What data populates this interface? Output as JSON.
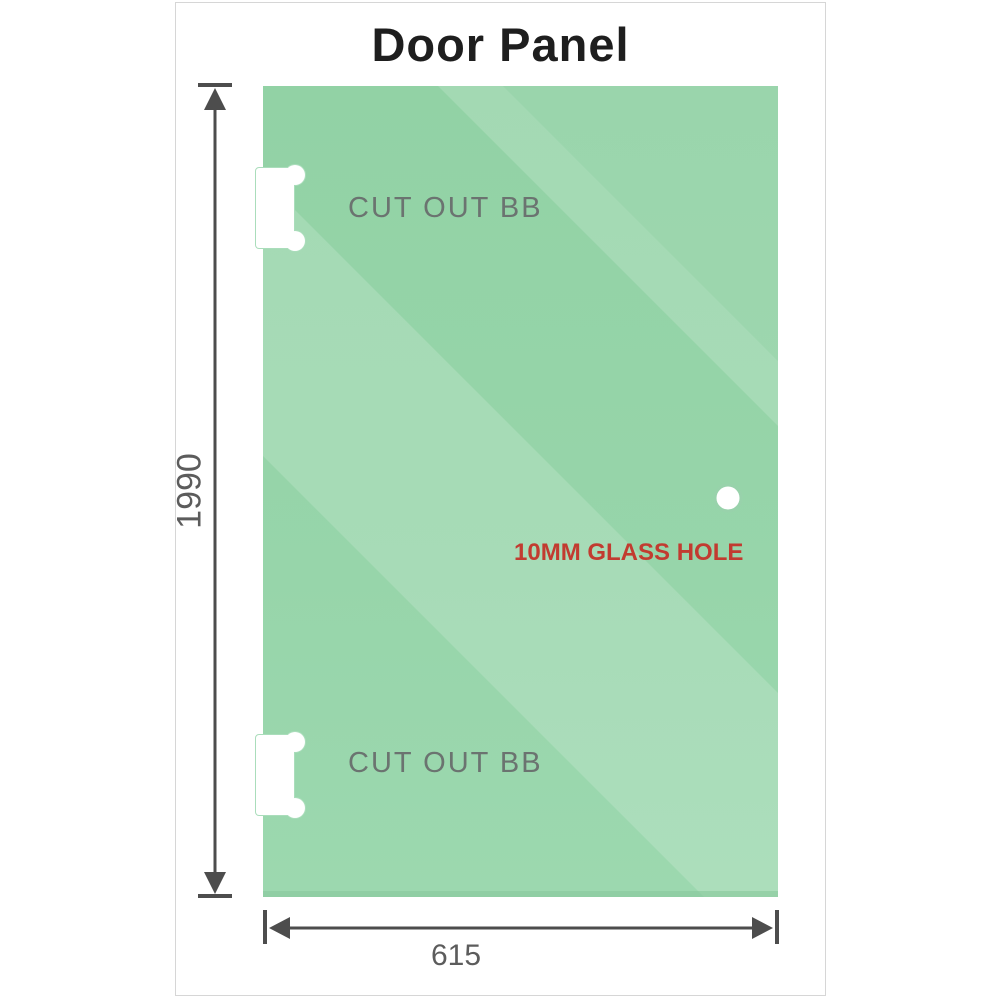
{
  "title": "Door Panel",
  "panel": {
    "cutout_top_label": "CUT OUT BB",
    "cutout_bottom_label": "CUT OUT BB",
    "hole_label": "10MM GLASS HOLE"
  },
  "dimensions": {
    "height": "1990",
    "width": "615"
  },
  "colors": {
    "glass_base": "#94d3a7",
    "glass_base_bottom": "#9cd8af",
    "glass_edge": "#8bca9e",
    "cutout_outline": "#aaddbb",
    "hole_ring": "#98d2ab",
    "dimension_line": "#4d4d4d",
    "label_gray": "#6b7370",
    "dim_text": "#5c5c5c",
    "hole_text_red": "#c23b30",
    "title_color": "#1e1e1e",
    "card_border": "#d6d6d6"
  }
}
